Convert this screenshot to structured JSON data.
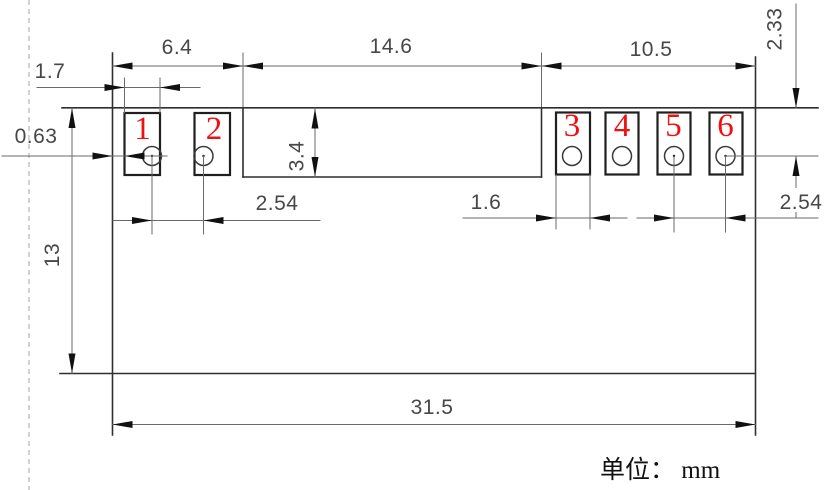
{
  "drawing": {
    "title_note": "单位： mm",
    "pads": [
      {
        "label": "1"
      },
      {
        "label": "2"
      },
      {
        "label": "3"
      },
      {
        "label": "4"
      },
      {
        "label": "5"
      },
      {
        "label": "6"
      }
    ],
    "dimensions": {
      "top_section_left": "6.4",
      "top_section_middle": "14.6",
      "top_section_right": "10.5",
      "pad1_width": "1.7",
      "edge_to_pad_gap": "0.63",
      "notch_depth": "3.4",
      "left_hole_pitch": "2.54",
      "pad3_width": "1.6",
      "right_hole_pitch": "2.54",
      "hole_center_offset": "2.33",
      "body_height": "13",
      "body_width": "31.5"
    },
    "colors": {
      "outline": "#2f2f2f",
      "dimension_lines": "#6a6a6a",
      "pad_numbers": "#ee1111",
      "arrows": "#111111"
    }
  }
}
